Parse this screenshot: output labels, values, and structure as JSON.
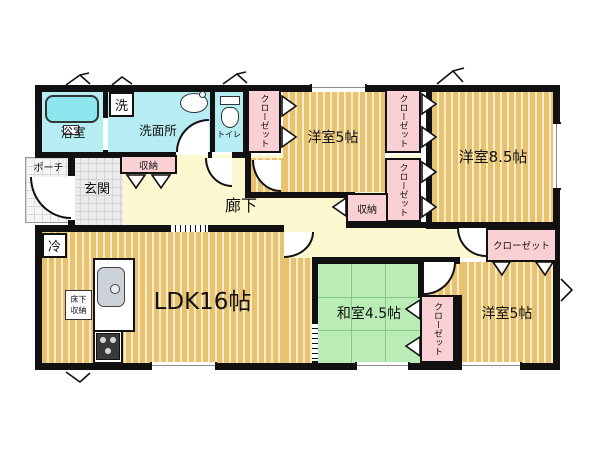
{
  "plan": {
    "bathroom": "浴室",
    "laundry": "洗",
    "washroom": "洗面所",
    "toilet": "トイレ",
    "porch": "ポーチ",
    "entrance": "玄関",
    "entrance_storage": "収納",
    "corridor": "廊下",
    "hall_storage": "収納",
    "fridge": "冷",
    "ldk": "LDK16帖",
    "underfloor_storage_line1": "床下",
    "underfloor_storage_line2": "収納",
    "western_room_5_top": "洋室5帖",
    "western_room_85": "洋室8.5帖",
    "western_room_5_bottom": "洋室5帖",
    "japanese_room_45": "和室4.5帖",
    "closet_top_left": "クローゼット",
    "closet_right_upper": "クローゼット",
    "closet_right_lower": "クローゼット",
    "closet_east": "クローゼット",
    "closet_japanese": "クローゼット"
  },
  "colors": {
    "wall": "#111111",
    "wood_floor": "#e9c26f",
    "wood_floor_stripe": "#f7edca",
    "wet_area": "#b6edf2",
    "closet_pink": "#f9d0d4",
    "corridor_yellow": "#fcf8cf",
    "tatami_green": "#b9edb5"
  }
}
